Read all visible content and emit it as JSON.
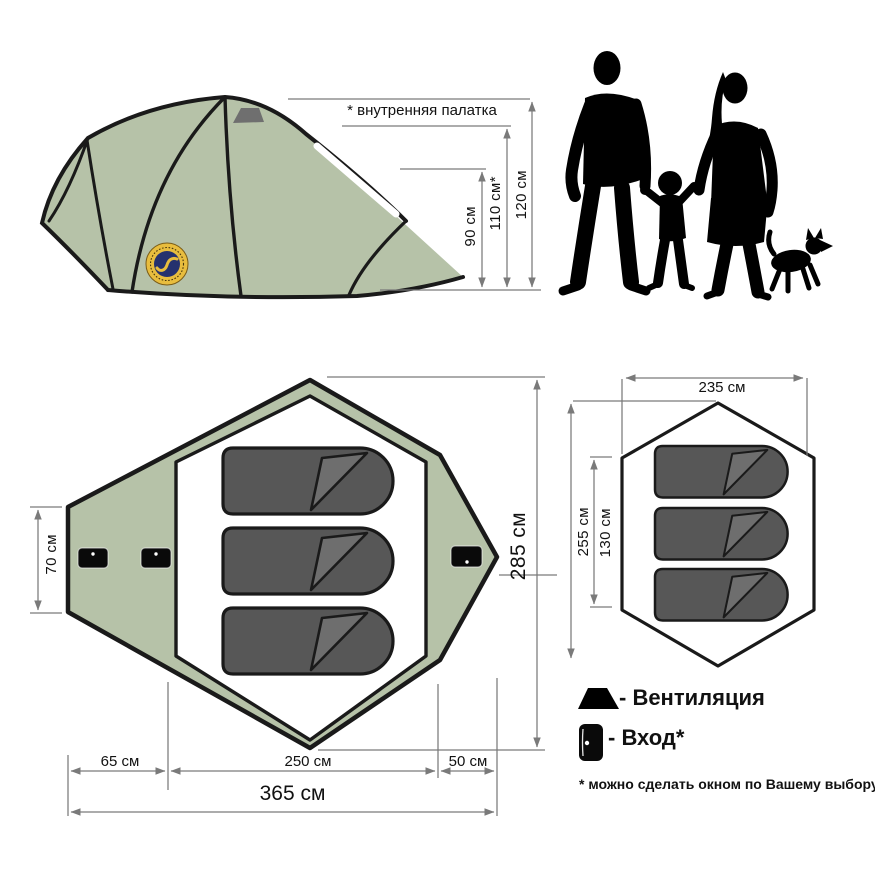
{
  "colors": {
    "background": "#ffffff",
    "tent_green": "#b6c2a8",
    "outline": "#1a1a1a",
    "bag_fill": "#575757",
    "bag_flap": "#6e6e6e",
    "vent_gray": "#6f6f6f",
    "dim_gray": "#7a7a7a",
    "text": "#111111",
    "logo_gold": "#e8bd3e",
    "logo_navy": "#25316e",
    "silhouette": "#000000"
  },
  "icons": {
    "ventilation": "black-trapezoid",
    "entrance": "black-door-with-white-dot"
  },
  "side_view": {
    "inner_tent_note": "* внутренняя палатка",
    "height_90": "90 см",
    "height_110": "110 см*",
    "height_120": "120 см"
  },
  "floor_plan": {
    "width_70": "70 см",
    "length_285": "285 см",
    "seg_65": "65 см",
    "seg_250": "250 см",
    "seg_50": "50 см",
    "total_365": "365 см"
  },
  "inner_plan": {
    "width_235": "235 см",
    "length_255": "255 см",
    "seg_130": "130 см"
  },
  "legend": {
    "ventilation": "- Вентиляция",
    "entrance": "- Вход*",
    "footnote": "* можно сделать окном по Вашему выбору"
  }
}
